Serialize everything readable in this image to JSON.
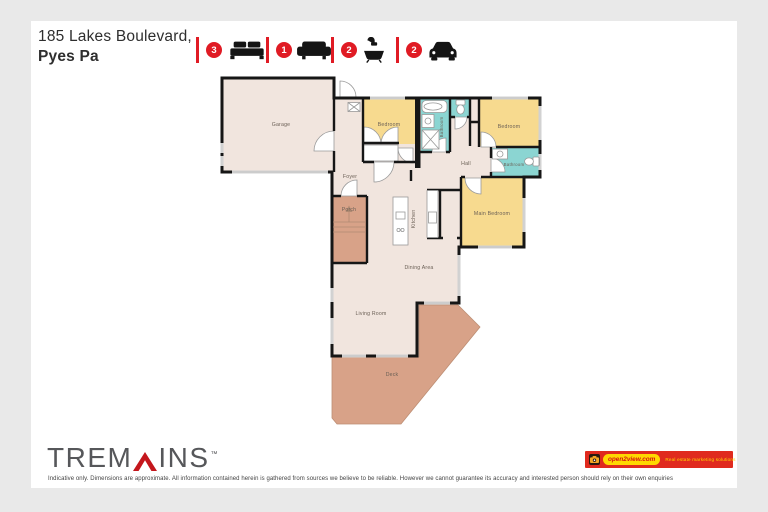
{
  "header": {
    "address_line1": "185 Lakes Boulevard,",
    "address_line2": "Pyes Pa",
    "accent_color": "#e01b24",
    "stats": [
      {
        "icon": "bed-icon",
        "count": "3"
      },
      {
        "icon": "sofa-icon",
        "count": "1"
      },
      {
        "icon": "bath-icon",
        "count": "2"
      },
      {
        "icon": "car-icon",
        "count": "2"
      }
    ]
  },
  "floorplan": {
    "rooms": {
      "garage": "Garage",
      "bedroom1": "Bedroom",
      "bathroom1": "Bathroom",
      "bedroom2": "Bedroom",
      "hall": "Hall",
      "bathroom2": "Bathroom",
      "main_bedroom": "Main Bedroom",
      "foyer": "Foyer",
      "porch": "Porch",
      "kitchen": "Kitchen",
      "dining": "Dining Area",
      "living": "Living Room",
      "deck": "Deck"
    },
    "colors": {
      "floor": "#f1e5de",
      "bedroom": "#f7da8f",
      "bathroom": "#8bd5d2",
      "deck": "#d8a288",
      "wall": "#161616"
    }
  },
  "footer": {
    "brand_part1": "TREM",
    "brand_part2": "INS",
    "brand_caret": "roof-caret-icon",
    "trademark": "™",
    "disclaimer": "Indicative only. Dimensions are approximate. All information contained herein is gathered from sources we believe to be reliable. However we cannot guarantee its accuracy and interested person should rely on their own enquiries",
    "open2view": {
      "domain": "open2view.com",
      "tagline": "Real estate marketing solutions"
    }
  }
}
